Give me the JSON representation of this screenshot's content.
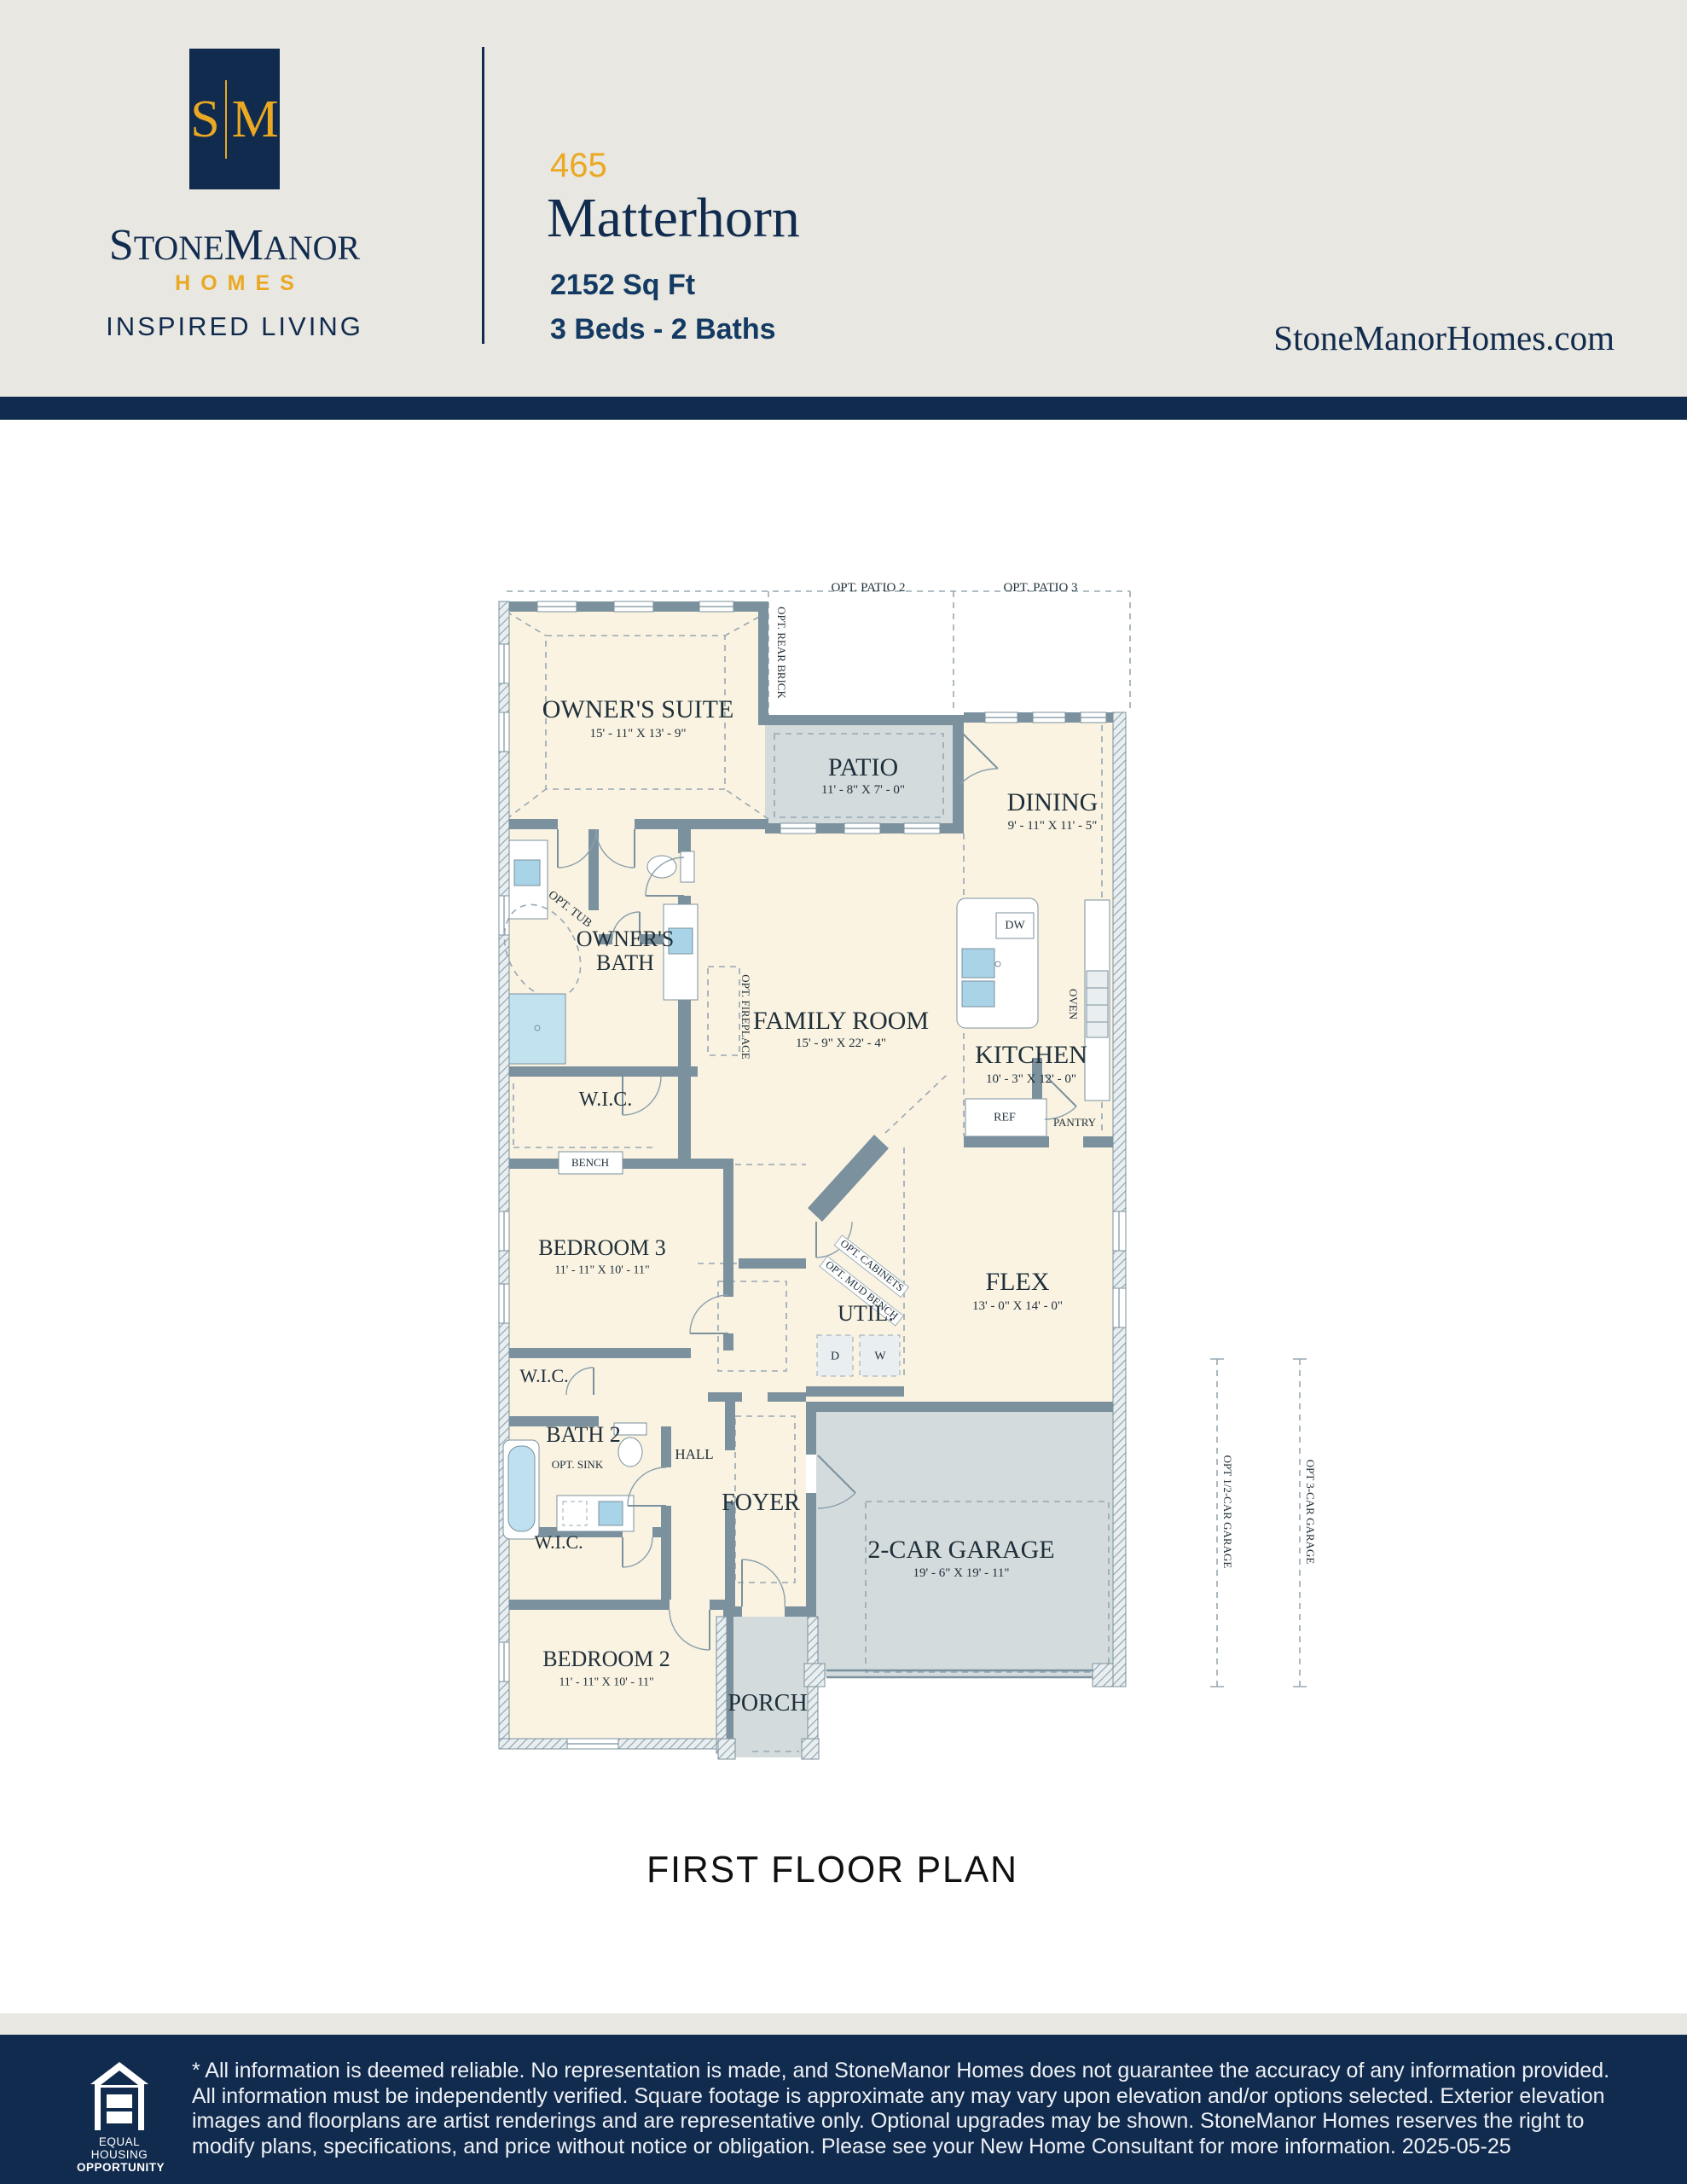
{
  "colors": {
    "navy": "#112b4e",
    "gold": "#eaa823",
    "paper": "#e8e7e1",
    "wall": "#7b919d",
    "cream": "#faf3e2",
    "grayroom": "#d3dbdd",
    "ink": "#20303a",
    "dash": "#97a8b2",
    "foot-text": "#eef1f6"
  },
  "header": {
    "monogram_left": "S",
    "monogram_right": "M",
    "brand_s": "S",
    "brand_tone": "TONE",
    "brand_m": "M",
    "brand_anor": "ANOR",
    "homes": "HOMES",
    "tagline": "INSPIRED LIVING",
    "plan_number": "465",
    "plan_name": "Matterhorn",
    "sqft": "2152 Sq Ft",
    "beds_baths": "3 Beds - 2 Baths",
    "website": "StoneManorHomes.com"
  },
  "plan": {
    "caption": "FIRST FLOOR PLAN",
    "rooms": {
      "owners_suite": {
        "label": "OWNER'S SUITE",
        "dims": "15' - 11\" X 13' - 9\""
      },
      "patio": {
        "label": "PATIO",
        "dims": "11' - 8\" X 7' - 0\""
      },
      "dining": {
        "label": "DINING",
        "dims": "9' - 11\" X 11' - 5\""
      },
      "owners_bath": {
        "label": "OWNER'S BATH"
      },
      "family_room": {
        "label": "FAMILY ROOM",
        "dims": "15' - 9\" X 22' - 4\""
      },
      "kitchen": {
        "label": "KITCHEN",
        "dims": "10' - 3\" X 12' - 0\""
      },
      "wic_owners": {
        "label": "W.I.C."
      },
      "bedroom3": {
        "label": "BEDROOM 3",
        "dims": "11' - 11\" X 10' - 11\""
      },
      "flex": {
        "label": "FLEX",
        "dims": "13' - 0\" X 14' - 0\""
      },
      "util": {
        "label": "UTIL."
      },
      "wic_bed3": {
        "label": "W.I.C."
      },
      "bath2": {
        "label": "BATH 2"
      },
      "hall": {
        "label": "HALL"
      },
      "foyer": {
        "label": "FOYER"
      },
      "garage": {
        "label": "2-CAR GARAGE",
        "dims": "19' - 6\" X 19' - 11\""
      },
      "wic_bed2": {
        "label": "W.I.C."
      },
      "bedroom2": {
        "label": "BEDROOM 2",
        "dims": "11' - 11\" X 10' - 11\""
      },
      "porch": {
        "label": "PORCH"
      }
    },
    "features": {
      "opt_patio2": "OPT. PATIO 2",
      "opt_patio3": "OPT. PATIO 3",
      "opt_rear_brick": "OPT. REAR BRICK",
      "opt_tub": "OPT. TUB",
      "opt_fireplace": "OPT. FIREPLACE",
      "dw": "DW",
      "oven": "OVEN",
      "ref": "REF",
      "pantry": "PANTRY",
      "bench": "BENCH",
      "opt_cabinets": "OPT. CABINETS",
      "opt_mud_bench": "OPT. MUD BENCH",
      "d": "D",
      "w": "W",
      "opt_sink": "OPT. SINK",
      "opt_half_garage": "OPT 1/2-CAR GARAGE",
      "opt_3car_garage": "OPT 3-CAR GARAGE"
    }
  },
  "footer": {
    "eho_line1": "EQUAL HOUSING",
    "eho_line2": "OPPORTUNITY",
    "disclaimer": "* All information is deemed reliable. No representation is made, and StoneManor Homes does not guarantee the accuracy of any information provided. All information must be independently verified. Square footage is approximate any may vary upon elevation and/or options selected. Exterior elevation images and floorplans are artist renderings and are representative only. Optional upgrades may be shown. StoneManor Homes reserves the right to modify plans, specifications, and price without notice or obligation. Please see your New Home Consultant for more information. 2025-05-25"
  }
}
